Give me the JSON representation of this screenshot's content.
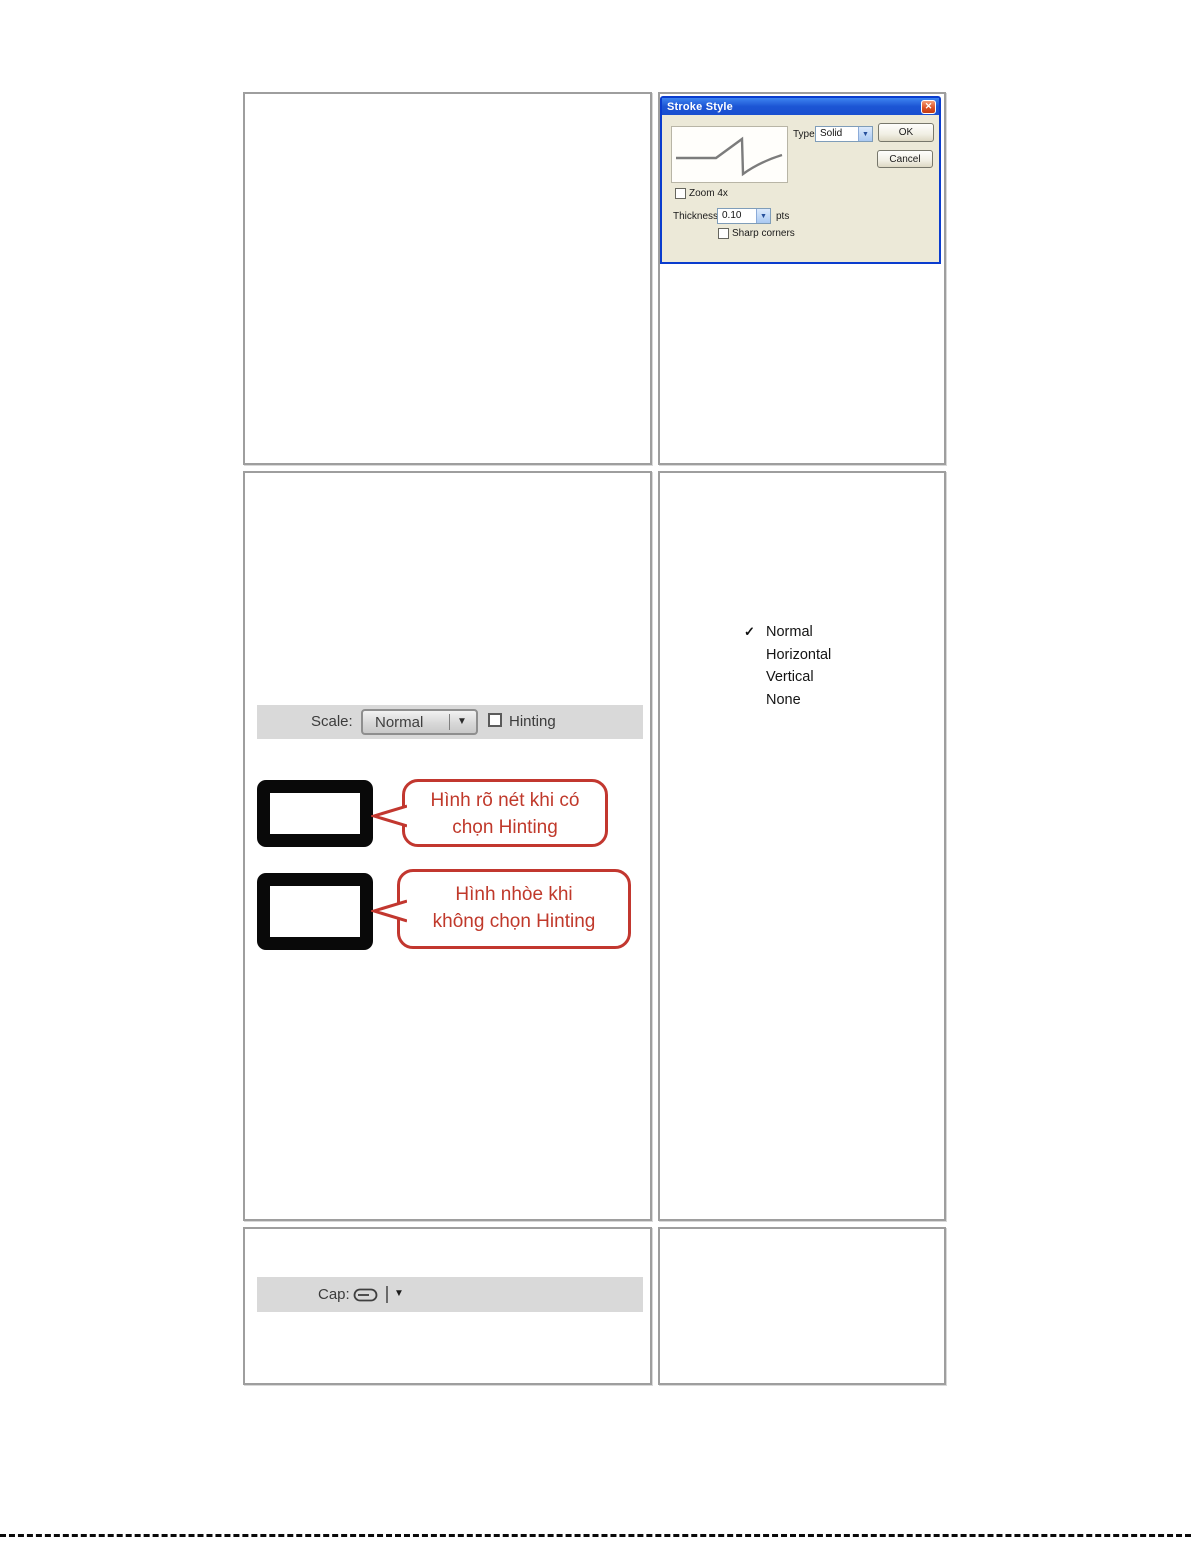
{
  "glyphs": {
    "close": "✕",
    "combo_arrow": "▼",
    "dropdown_arrow": "▼",
    "check": "✓"
  },
  "dialog": {
    "title": "Stroke Style",
    "zoom_label": "Zoom 4x",
    "type_label": "Type:",
    "type_value": "Solid",
    "ok_label": "OK",
    "cancel_label": "Cancel",
    "thickness_label": "Thickness:",
    "thickness_value": "0.10",
    "thickness_unit": "pts",
    "sharp_corners_label": "Sharp corners"
  },
  "scale_bar": {
    "label": "Scale:",
    "value": "Normal",
    "hinting_label": "Hinting"
  },
  "menu": {
    "items": [
      {
        "label": "Normal",
        "checked": true
      },
      {
        "label": "Horizontal",
        "checked": false
      },
      {
        "label": "Vertical",
        "checked": false
      },
      {
        "label": "None",
        "checked": false
      }
    ]
  },
  "callout_sharp": {
    "line1": "Hình rõ nét khi có",
    "line2": "chọn Hinting"
  },
  "callout_blur": {
    "line1": "Hình nhòe khi",
    "line2": "không chọn Hinting"
  },
  "cap_bar": {
    "label": "Cap:"
  },
  "colors": {
    "titlebar_blue": "#1c55d4",
    "dialog_bg": "#ece9d8",
    "callout_red": "#c0392b",
    "bar_gray": "#d9d9d9",
    "table_border": "#9e9e9e"
  }
}
